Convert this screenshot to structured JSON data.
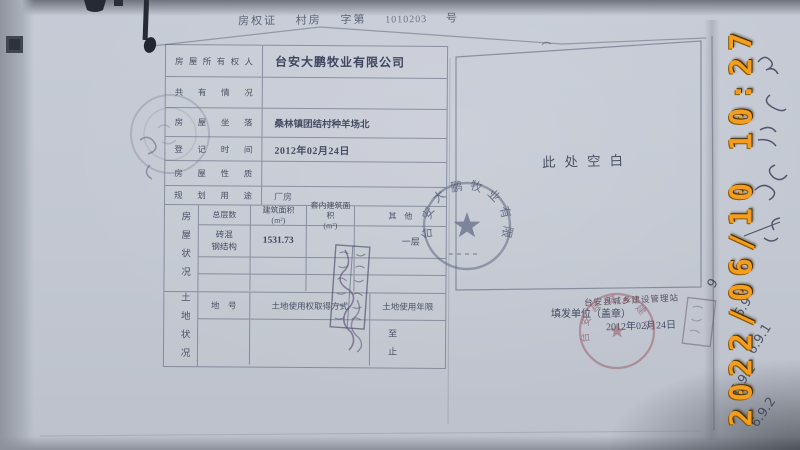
{
  "photo": {
    "timestamp": "2022/06/10 10:27"
  },
  "header": {
    "title": "房权证",
    "type": "村房",
    "zi_label": "字第",
    "number": "1010203",
    "hao_label": "号"
  },
  "certificate": {
    "rows": [
      {
        "label": "房屋所有权人",
        "value": "台安大鹏牧业有限公司"
      },
      {
        "label": "共有情况",
        "value": ""
      },
      {
        "label": "房屋坐落",
        "value": "桑林镇团结村种羊场北"
      },
      {
        "label": "登记时间",
        "value": "2012年02月24日"
      },
      {
        "label": "房屋性质",
        "value": ""
      },
      {
        "label": "规划用途",
        "value": "厂房"
      }
    ],
    "house_section": {
      "side_label": "房屋状况",
      "columns": [
        "总层数",
        "建筑面积\n(m²)",
        "套内建筑面积\n(m²)",
        "其　他"
      ],
      "structure_line1": "砖混",
      "structure_line2": "钢结构",
      "area": "1531.73",
      "inner_area": "",
      "other": "一层"
    },
    "land_section": {
      "side_label": "土地状况",
      "columns": [
        "地　号",
        "土地使用权取得方式",
        "土地使用年限"
      ],
      "term_line1": "至",
      "term_line2": "止"
    }
  },
  "right_page": {
    "blank_text": "此处空白",
    "issuer_label": "填发单位（盖章）",
    "issuer_name": "台安县城乡建设管理站",
    "issue_date": "2012年02月24日"
  },
  "seals": {
    "company_seal_text": "台安大鹏牧业有限公司",
    "issuer_seal_text": "台安县城乡建设管理站"
  },
  "annotations": {
    "handwritten_numbers": [
      "9",
      "6.9",
      "6.9.1",
      "6.9.2",
      "6.9.2"
    ]
  }
}
